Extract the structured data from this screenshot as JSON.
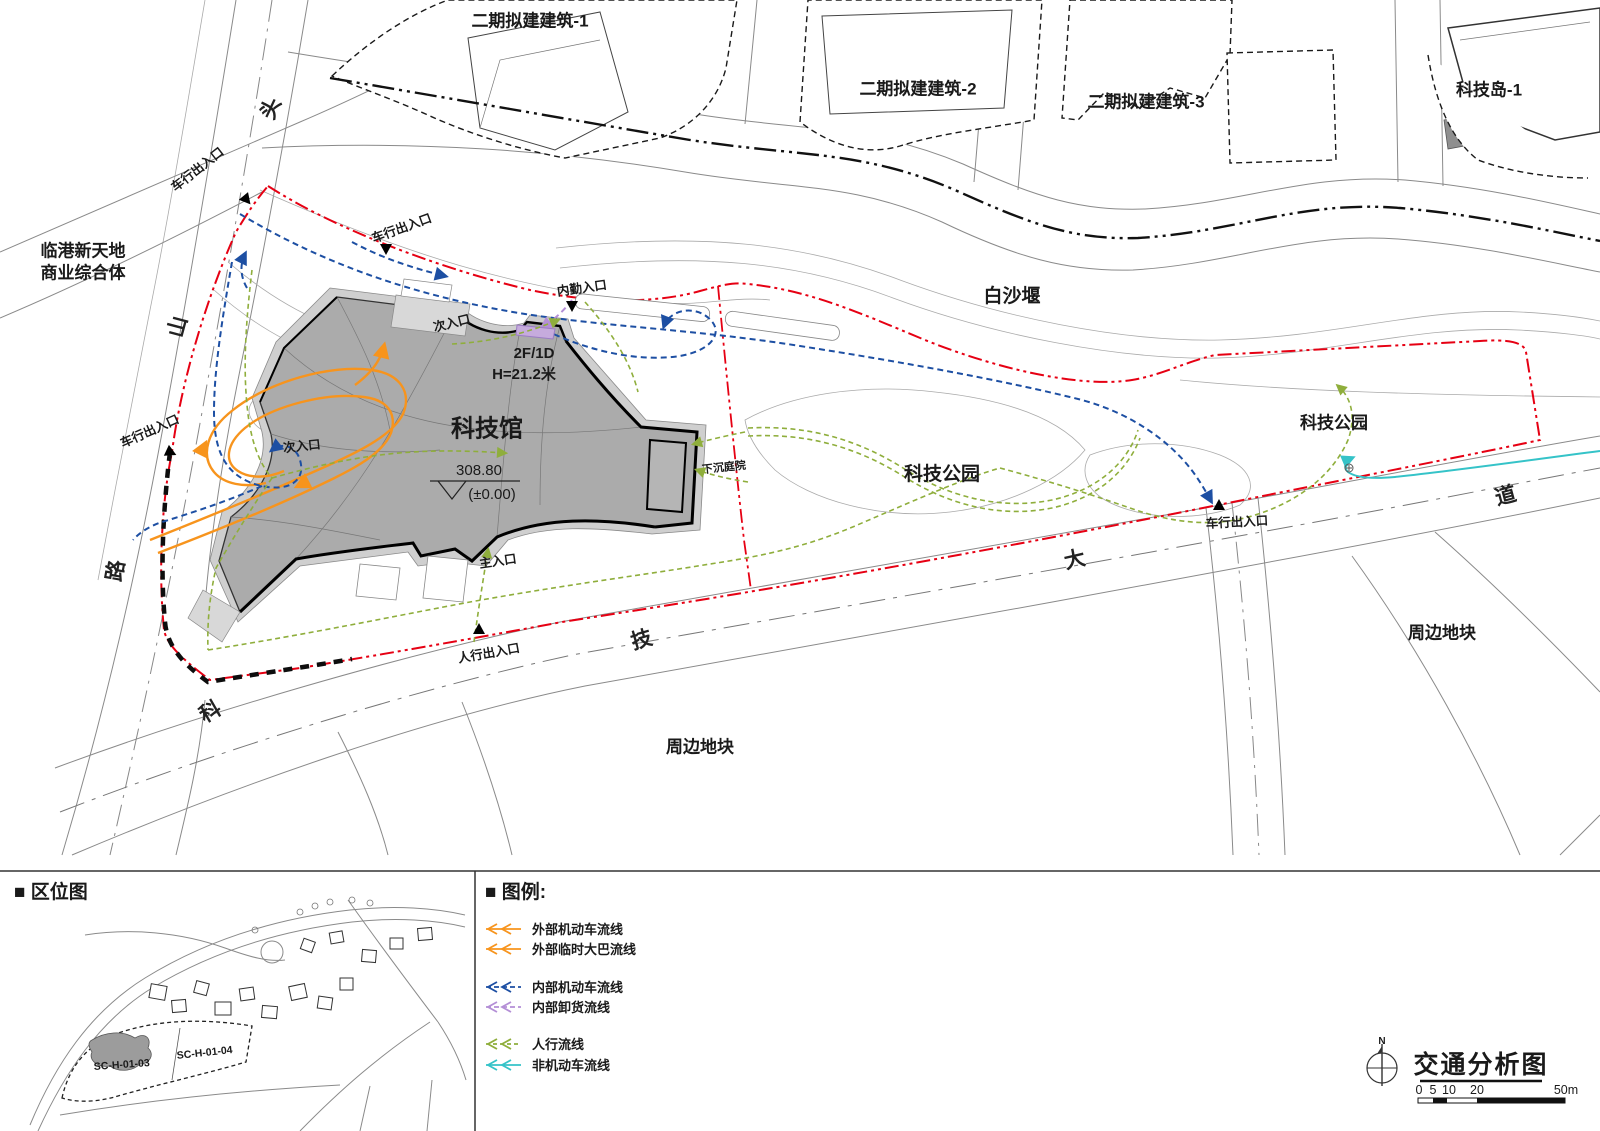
{
  "map": {
    "parcels": {
      "phase2_1": "二期拟建建筑-1",
      "phase2_2": "二期拟建建筑-2",
      "phase2_3": "二期拟建建筑-3",
      "tech_island": "科技岛-1"
    },
    "areas": {
      "commercial_line1": "临港新天地",
      "commercial_line2": "商业综合体",
      "baishayan": "白沙堰",
      "tech_park": "科技公园",
      "surrounding": "周边地块",
      "sunken_courtyard": "下沉庭院"
    },
    "building": {
      "name": "科技馆",
      "elevation": "308.80",
      "elevation_datum": "(±0.00)",
      "floors": "2F/1D",
      "height": "H=21.2米"
    },
    "entrances": {
      "vehicle": "车行出入口",
      "staff": "内勤入口",
      "secondary": "次入口",
      "main": "主入口",
      "pedestrian": "人行出入口"
    },
    "road_chars": {
      "shan": "山",
      "tou": "头",
      "lu": "路",
      "ke": "科",
      "ji": "技",
      "da": "大",
      "dao": "道"
    }
  },
  "location_panel": {
    "title": "■ 区位图",
    "site_code": "SC-H-01-03",
    "adjacent_code": "SC-H-01-04"
  },
  "legend_panel": {
    "title": "■ 图例:",
    "items": [
      {
        "label": "外部机动车流线",
        "color": "#f7941d"
      },
      {
        "label": "外部临时大巴流线",
        "color": "#f7941d"
      },
      {
        "label": "内部机动车流线",
        "color": "#1d4fa3"
      },
      {
        "label": "内部卸货流线",
        "color": "#b48fd6"
      },
      {
        "label": "人行流线",
        "color": "#8fae3c"
      },
      {
        "label": "非机动车流线",
        "color": "#35c3c8"
      }
    ]
  },
  "title_block": {
    "north_label": "N",
    "title": "交通分析图",
    "scale_ticks": [
      "0",
      "5",
      "10",
      "20",
      "50m"
    ]
  }
}
